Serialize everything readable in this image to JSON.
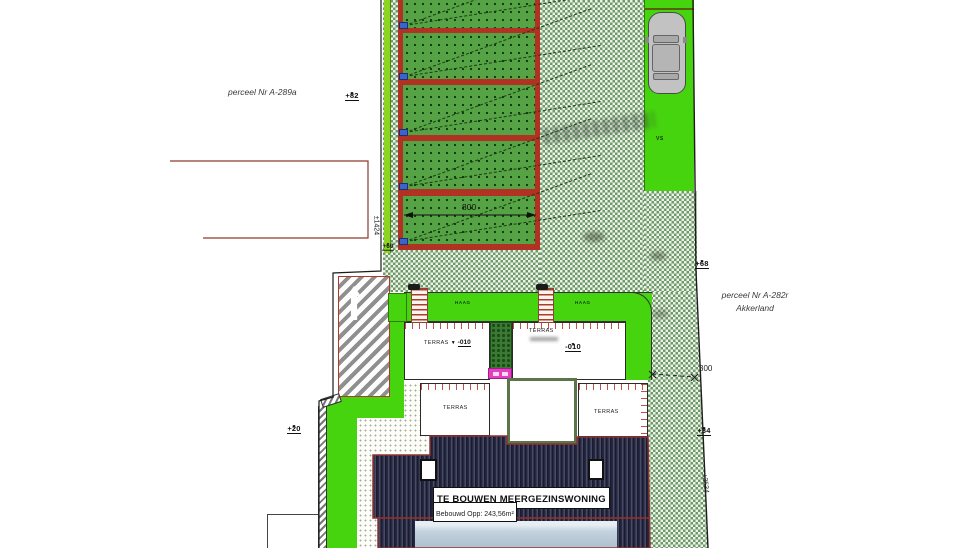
{
  "scene": {
    "parcel_left_label": "perceel Nr A-289a",
    "parcel_right_label": "perceel Nr A-282r",
    "parcel_right_sublabel": "Akkerland",
    "building_title": "TE BOUWEN MEERGEZINSWONING",
    "building_area": "Bebouwd Opp: 243,56m²",
    "hedge_label_left": "HAAG",
    "hedge_label_right": "HAAG",
    "terrace_upper_left_label": "TERRAS",
    "terrace_upper_left_level": "-010",
    "terrace_upper_right_label": "TERRAS",
    "terrace_upper_right_level": "-010",
    "terrace_lower_left_label": "TERRAS",
    "terrace_lower_right_label": "TERRAS",
    "parking_label": "VS",
    "dim_plot_width": "800",
    "dim_rear_offset": "300",
    "dim_left_boundary": "±1424",
    "dim_right_boundary": "±3534",
    "level_top": "+82",
    "level_right_upper": "+68",
    "level_right_lower": "+34",
    "level_left": "+20",
    "level_plots": "+60",
    "marker_glyph": "▼"
  },
  "colors": {
    "grass_bright": "#46d40e",
    "plot_green": "#56a345",
    "plot_border_red": "#b13222",
    "checker_green": "#6e9a6a",
    "roof_dark": "#262840",
    "roof_light_deck": "#c3d3df",
    "hedge_dark": "#3a7a33",
    "accent_magenta": "#e33fc0",
    "boundary_black": "#1c1c1c",
    "ramp_stripe_gray": "#999999"
  }
}
